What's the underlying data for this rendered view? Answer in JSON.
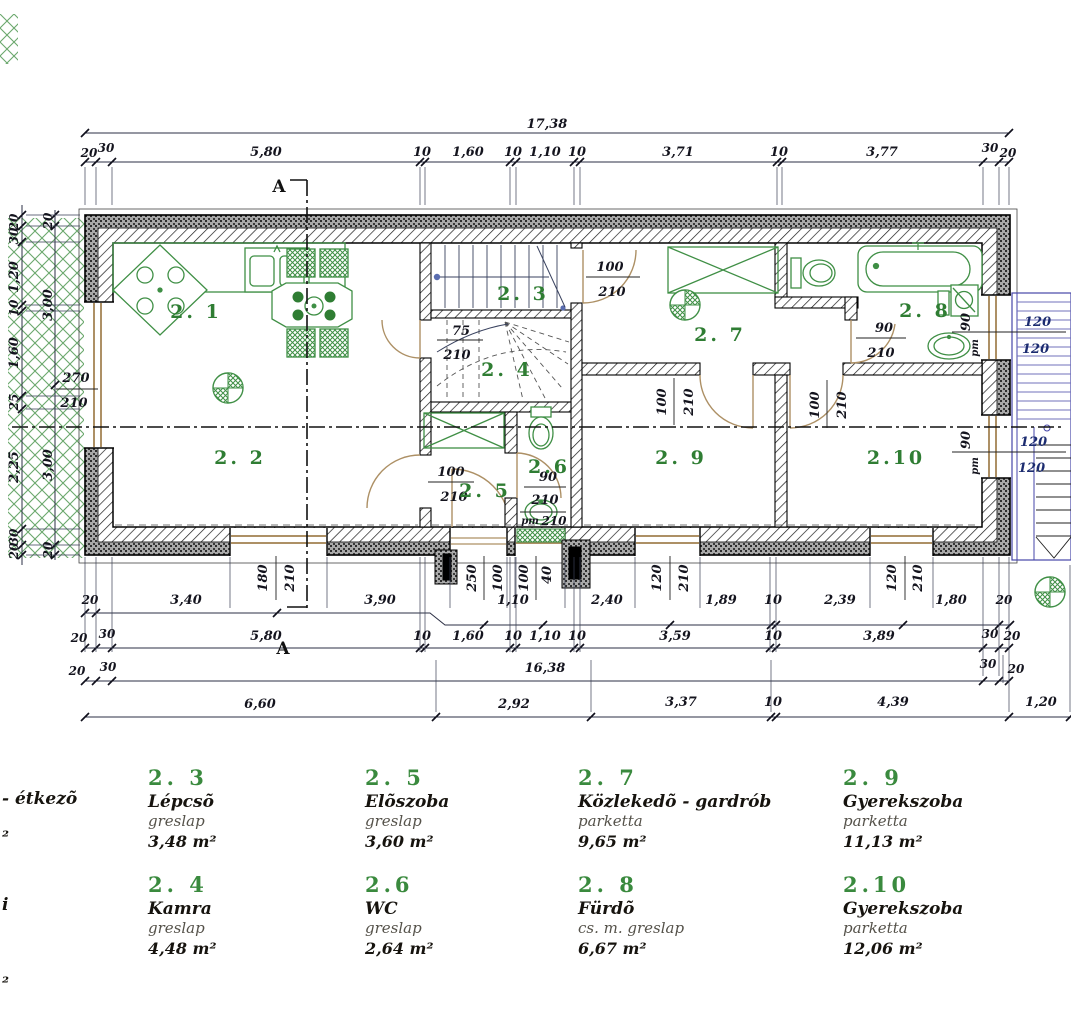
{
  "plan": {
    "section_mark": "A",
    "rooms": {
      "r21": "2. 1",
      "r22": "2. 2",
      "r23": "2. 3",
      "r24": "2. 4",
      "r25": "2. 5",
      "r26": "2.6",
      "r27": "2. 7",
      "r28": "2. 8",
      "r29": "2. 9",
      "r210": "2.10"
    },
    "openings": {
      "left_window": [
        "270",
        "210"
      ],
      "kamra_door": [
        "75",
        "210"
      ],
      "hall_top_door": [
        "100",
        "210"
      ],
      "bath_door": [
        "90",
        "210"
      ],
      "wc_door": [
        "90",
        "210"
      ],
      "wc_window": [
        "pm",
        "210"
      ],
      "eloszoba_door": [
        "100",
        "210"
      ],
      "room9_door": [
        "100",
        "210"
      ],
      "room10_door": [
        "100",
        "210"
      ],
      "bath_win1": [
        "90",
        "pm"
      ],
      "bath_win2": [
        "90",
        "pm"
      ],
      "right_win_sizes": [
        "120",
        "120",
        "120",
        "120"
      ],
      "bottom_w1": [
        "180",
        "210"
      ],
      "entry": [
        "100",
        "250",
        "100",
        "40"
      ],
      "bottom_w2": [
        "120",
        "210"
      ],
      "bottom_w3": [
        "120",
        "210"
      ]
    }
  },
  "dims": {
    "top_total": "17,38",
    "top_chain": [
      "20",
      "30",
      "5,80",
      "10",
      "1,60",
      "10",
      "1,10",
      "10",
      "3,71",
      "10",
      "3,77",
      "30",
      "20"
    ],
    "bottom_row1": [
      "20",
      "3,40",
      "3,90",
      "1,10",
      "2,40",
      "1,89",
      "10",
      "2,39",
      "1,80",
      "20"
    ],
    "bottom_row2": [
      "20",
      "30",
      "5,80",
      "10",
      "1,60",
      "10",
      "1,10",
      "10",
      "3,59",
      "10",
      "3,89",
      "30",
      "20"
    ],
    "bottom_row3": [
      "20",
      "30",
      "16,38",
      "30",
      "20"
    ],
    "bottom_row4": [
      "6,60",
      "2,92",
      "3,37",
      "10",
      "4,39",
      "1,20"
    ],
    "left_outer": [
      "20",
      "30",
      "1,20",
      "10",
      "1,60",
      "25",
      "2,25",
      "30",
      "20"
    ],
    "left_inner": [
      "20",
      "3,00",
      "3,00",
      "20"
    ]
  },
  "legend": {
    "col1": {
      "row1_name_fragment": "- étkezõ",
      "row1_area_fragment": "²",
      "row2_name_fragment": "i",
      "row2_area_fragment": "²"
    },
    "items": [
      {
        "num": "2. 3",
        "name": "Lépcsõ",
        "material": "greslap",
        "area": "3,48 m²"
      },
      {
        "num": "2. 4",
        "name": "Kamra",
        "material": "greslap",
        "area": "4,48 m²"
      },
      {
        "num": "2. 5",
        "name": "Elõszoba",
        "material": "greslap",
        "area": "3,60 m²"
      },
      {
        "num": "2.6",
        "name": "WC",
        "material": "greslap",
        "area": "2,64 m²"
      },
      {
        "num": "2. 7",
        "name": "Közlekedõ - gardrób",
        "material": "parketta",
        "area": "9,65 m²"
      },
      {
        "num": "2. 8",
        "name": "Fürdõ",
        "material": "cs. m. greslap",
        "area": "6,67 m²"
      },
      {
        "num": "2. 9",
        "name": "Gyerekszoba",
        "material": "parketta",
        "area": "11,13 m²"
      },
      {
        "num": "2.10",
        "name": "Gyerekszoba",
        "material": "parketta",
        "area": "12,06 m²"
      }
    ]
  },
  "colors": {
    "green": "#2f7d33",
    "fixture_green": "#3f8f45",
    "tan": "#ad9065",
    "blue": "#4646a8",
    "wall": "#111111"
  }
}
